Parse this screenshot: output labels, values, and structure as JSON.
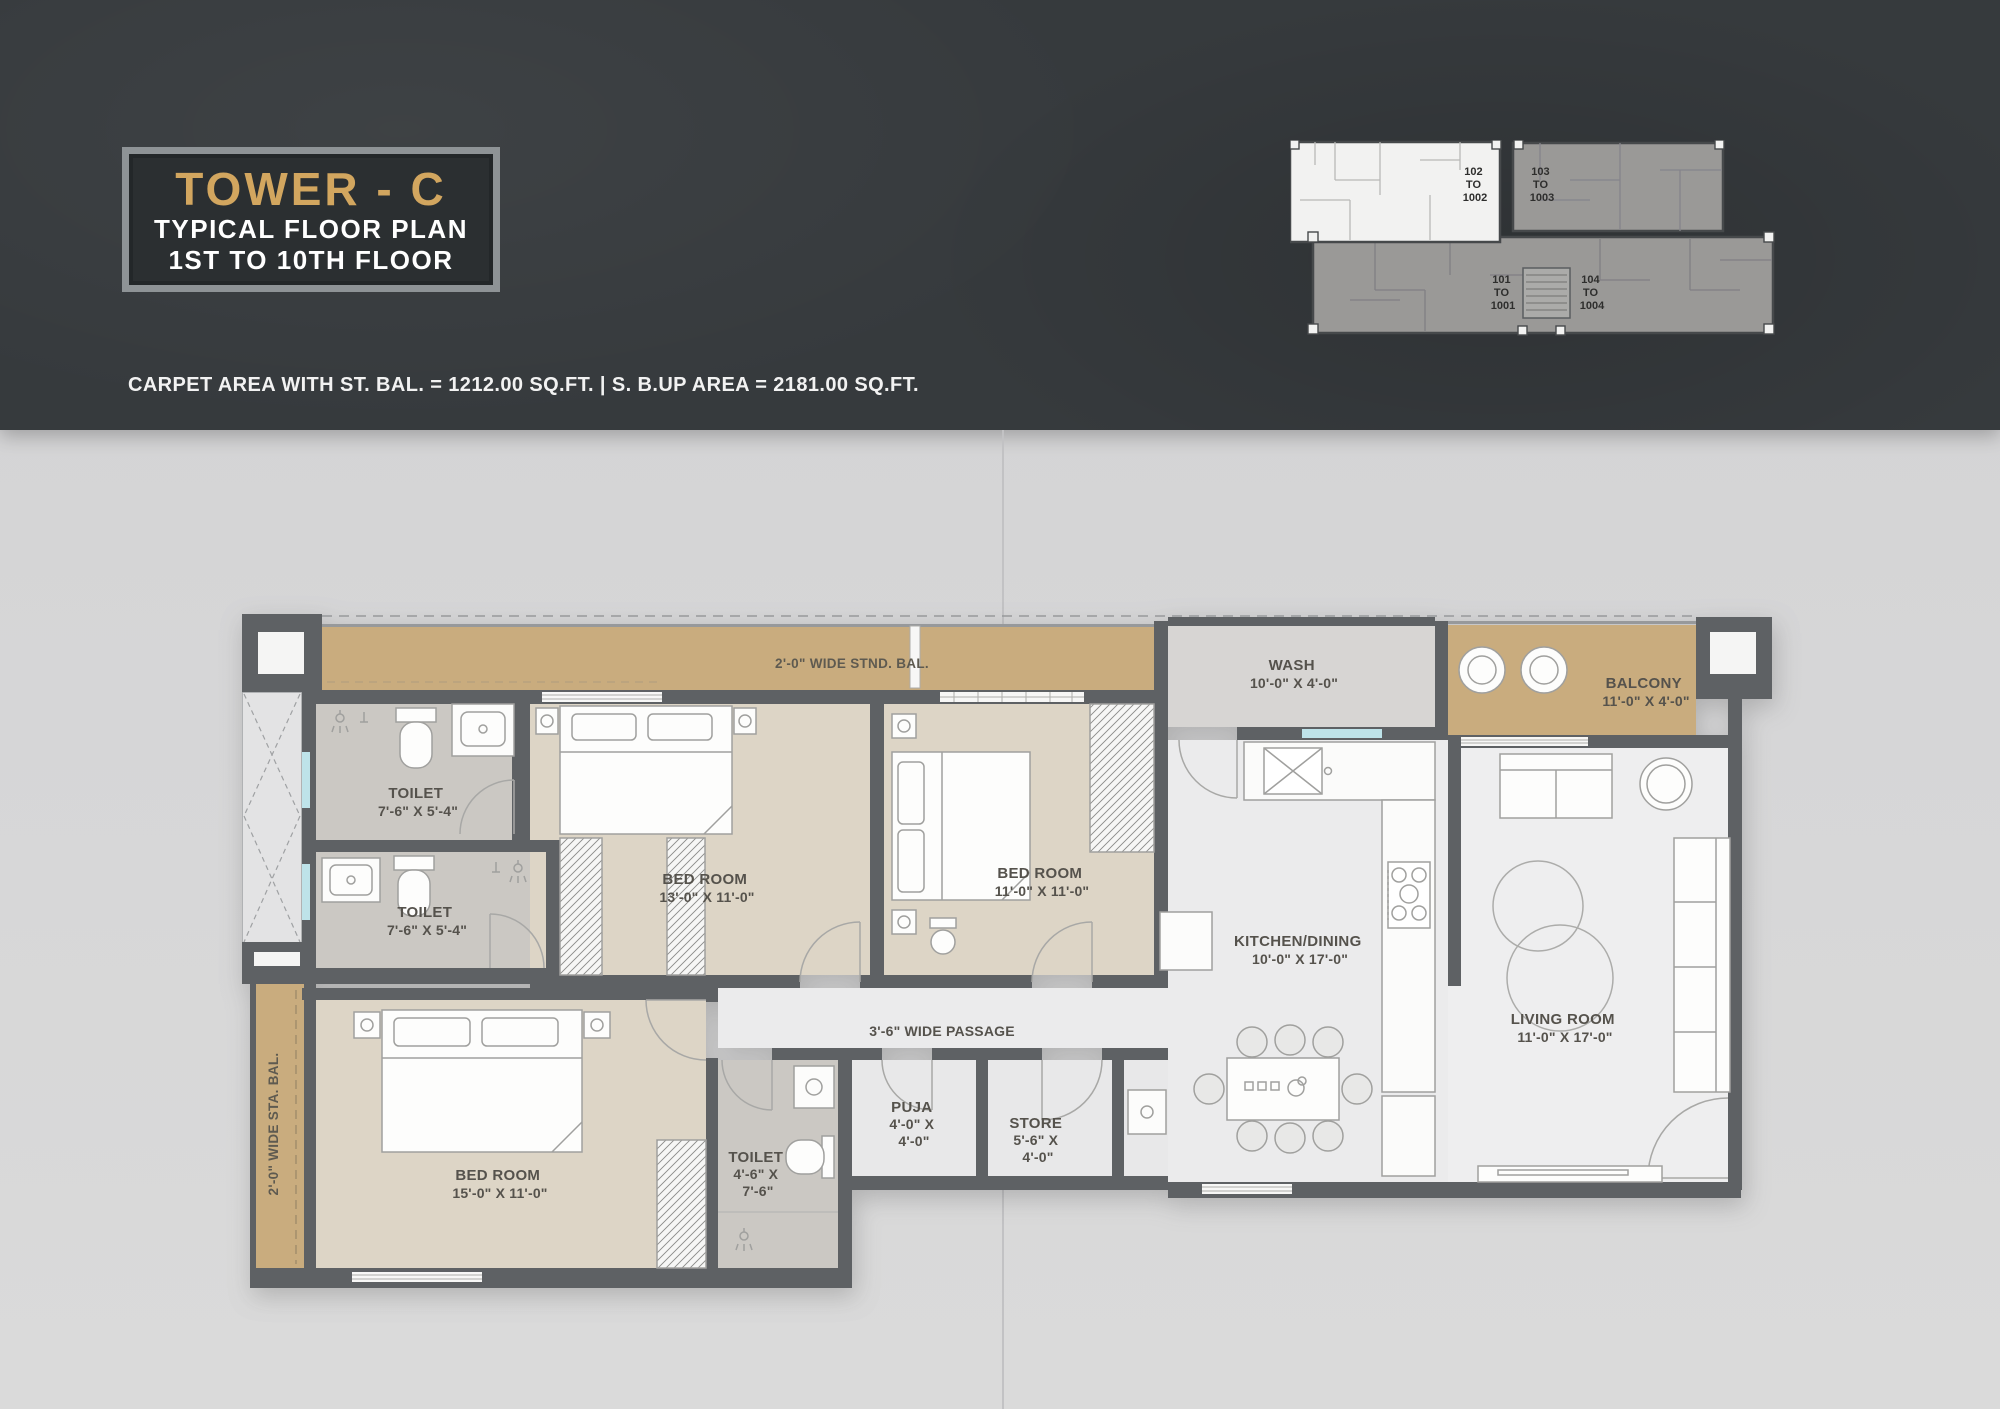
{
  "header": {
    "title": "TOWER - C",
    "subtitle1": "TYPICAL FLOOR PLAN",
    "subtitle2": "1ST TO 10TH FLOOR",
    "area_note": "CARPET AREA WITH ST. BAL. = 1212.00 SQ.FT. | S. B.UP AREA = 2181.00 SQ.FT.",
    "colors": {
      "background": "#363A3D",
      "title_gold": "#D2A65F",
      "text_white": "#FFFFFF"
    }
  },
  "key_plan": {
    "units": [
      {
        "line1": "102",
        "line2": "TO",
        "line3": "1002",
        "highlighted": true
      },
      {
        "line1": "103",
        "line2": "TO",
        "line3": "1003",
        "highlighted": false
      },
      {
        "line1": "101",
        "line2": "TO",
        "line3": "1001",
        "highlighted": false
      },
      {
        "line1": "104",
        "line2": "TO",
        "line3": "1004",
        "highlighted": false
      }
    ]
  },
  "floor_plan": {
    "rooms": {
      "stnd_bal": {
        "name": "2'-0\" WIDE STND. BAL."
      },
      "toilet_top": {
        "name": "TOILET",
        "dims": "7'-6\" X 5'-4\""
      },
      "toilet_mid": {
        "name": "TOILET",
        "dims": "7'-6\" X 5'-4\""
      },
      "bedroom_13": {
        "name": "BED ROOM",
        "dims": "13'-0\" X 11'-0\""
      },
      "bedroom_11": {
        "name": "BED ROOM",
        "dims": "11'-0\" X 11'-0\""
      },
      "wash": {
        "name": "WASH",
        "dims": "10'-0\" X 4'-0\""
      },
      "balcony": {
        "name": "BALCONY",
        "dims": "11'-0\" X 4'-0\""
      },
      "kitchen": {
        "name": "KITCHEN/DINING",
        "dims": "10'-0\" X 17'-0\""
      },
      "living": {
        "name": "LIVING ROOM",
        "dims": "11'-0\" X 17'-0\""
      },
      "passage": {
        "name": "3'-6\" WIDE PASSAGE"
      },
      "bedroom_15": {
        "name": "BED ROOM",
        "dims": "15'-0\" X 11'-0\""
      },
      "toilet_small": {
        "name": "TOILET",
        "dims1": "4'-6\" X",
        "dims2": "7'-6\""
      },
      "puja": {
        "name": "PUJA",
        "dims1": "4'-0\" X",
        "dims2": "4'-0\""
      },
      "store": {
        "name": "STORE",
        "dims1": "5'-6\" X",
        "dims2": "4'-0\""
      },
      "sta_bal": {
        "name": "2'-0\" WIDE STA. BAL."
      }
    },
    "colors": {
      "wall": "#5E6164",
      "balcony": "#C9AC7E",
      "bedroom": "#DDD5C6",
      "toilet": "#CBC8C3",
      "floor": "#ECECED",
      "window": "#BEE3E9"
    }
  }
}
